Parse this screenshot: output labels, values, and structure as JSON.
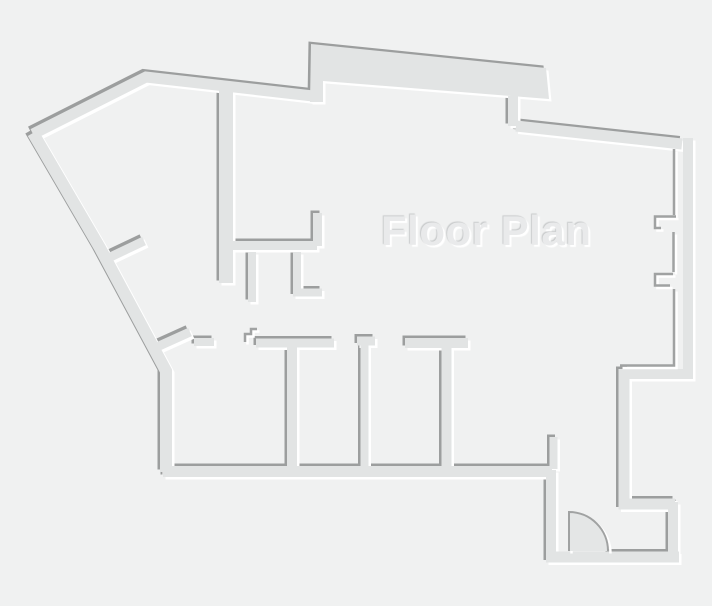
{
  "canvas": {
    "width": 712,
    "height": 606,
    "background": "#f0f1f1"
  },
  "title": {
    "text": "Floor Plan",
    "color": "#e9eaeb",
    "highlight_shadow": "2px 2px 1px #ffffff",
    "shade_shadow": "-1px -1px 1px #c9cbcc"
  },
  "palette": {
    "wall_fill": "#e2e4e4",
    "edge_dark": "#9c9e9e",
    "edge_light": "#ffffff",
    "thin_dark": "#a0a2a2",
    "door_fill": "#e4e6e6",
    "emboss_offset": 2.5
  },
  "walls": {
    "default_width": 11,
    "segments": [
      {
        "name": "outer-top",
        "path": "M33,134 L146,77 L313,96"
      },
      {
        "name": "outer-left",
        "path": "M33,133 L100,248 L166,371 L166,472",
        "width": 12
      },
      {
        "name": "top-bump-slab",
        "path": "M310,102 L311,44 L546,68 L549,99 L323,81 L323,102 Z",
        "fill": true
      },
      {
        "name": "bump-connector",
        "path": "M513,96 L513,126",
        "width": 10
      },
      {
        "name": "top-right",
        "path": "M516,126 L682,144"
      },
      {
        "name": "right-slab",
        "path": "M688,138 L688,374 L620,374",
        "width": 10,
        "no_dark": true
      },
      {
        "name": "entry-tall",
        "path": "M624,369 L624,504 L675,504"
      },
      {
        "name": "entry-right",
        "path": "M673,502 L673,558",
        "width": 10
      },
      {
        "name": "entry-bottom-left",
        "path": "M546,557 L554,557"
      },
      {
        "name": "entry-bottom-door-span",
        "path": "M553,557 L609,557",
        "no_dark": true
      },
      {
        "name": "entry-bottom-right",
        "path": "M608,557 L679,557"
      },
      {
        "name": "entry-left",
        "path": "M551,470 L551,562",
        "width": 10
      },
      {
        "name": "entry-jamb-stub",
        "path": "M553.5,437 L553.5,469",
        "width": 8
      },
      {
        "name": "rooms-bottom",
        "path": "M163,471.5 L552,471.5"
      },
      {
        "name": "interior-vertical",
        "path": "M226,89 L226,283",
        "width": 14
      },
      {
        "name": "interior-branch",
        "path": "M230,245.5 L317,245.5",
        "width": 9
      },
      {
        "name": "interior-riser",
        "path": "M317.5,213 L317.5,246",
        "width": 9
      },
      {
        "name": "interior-stub-a",
        "path": "M252,252 L252,302",
        "width": 8
      },
      {
        "name": "interior-stub-b",
        "path": "M297,252 L297,292.5 L322,292.5",
        "width": 8
      },
      {
        "name": "diag-stub-upper",
        "path": "M104,260 L144,241",
        "width": 9
      },
      {
        "name": "diag-stub-lower",
        "path": "M159,346 L190,332",
        "width": 9
      },
      {
        "name": "room1-top-short",
        "path": "M194,342 L214,342",
        "width": 8
      },
      {
        "name": "room1-top-main",
        "path": "M256,343 L334,343",
        "width": 9
      },
      {
        "name": "divider-1",
        "path": "M292,343 L292,470",
        "width": 10
      },
      {
        "name": "divider-2-cap",
        "path": "M357,341 L375,341",
        "width": 9
      },
      {
        "name": "divider-2",
        "path": "M364.5,343 L364.5,470",
        "width": 8
      },
      {
        "name": "divider-3-top",
        "path": "M405,343 L468,343",
        "width": 10
      },
      {
        "name": "divider-3",
        "path": "M446.5,347 L446.5,470",
        "width": 10
      }
    ]
  },
  "thin_lines": {
    "width": 2.5,
    "segments": [
      {
        "name": "right-inner-face-top",
        "path": "M674,149 L674,215"
      },
      {
        "name": "window-hook-1",
        "path": "M676,216.5 L655,216.5 L655,228 L661,228"
      },
      {
        "name": "right-inner-face-mid",
        "path": "M673.5,232 L673.5,272"
      },
      {
        "name": "window-hook-2",
        "path": "M673,274 L655,274 L655,285.5 L670,285.5"
      },
      {
        "name": "right-inner-face-low",
        "path": "M674,289 L674,365.5 L620,365.5"
      },
      {
        "name": "threshold-zigzag",
        "path": "M245,342 L245,334 L251,334 L251,329 L257,329"
      }
    ]
  },
  "door": {
    "sector_path": "M569,551 L569,512 A39,39 0 0 1 608,551 Z",
    "swing_path": "M569,551 L569,512 A39,39 0 0 1 608,551",
    "stroke_width": 2
  }
}
